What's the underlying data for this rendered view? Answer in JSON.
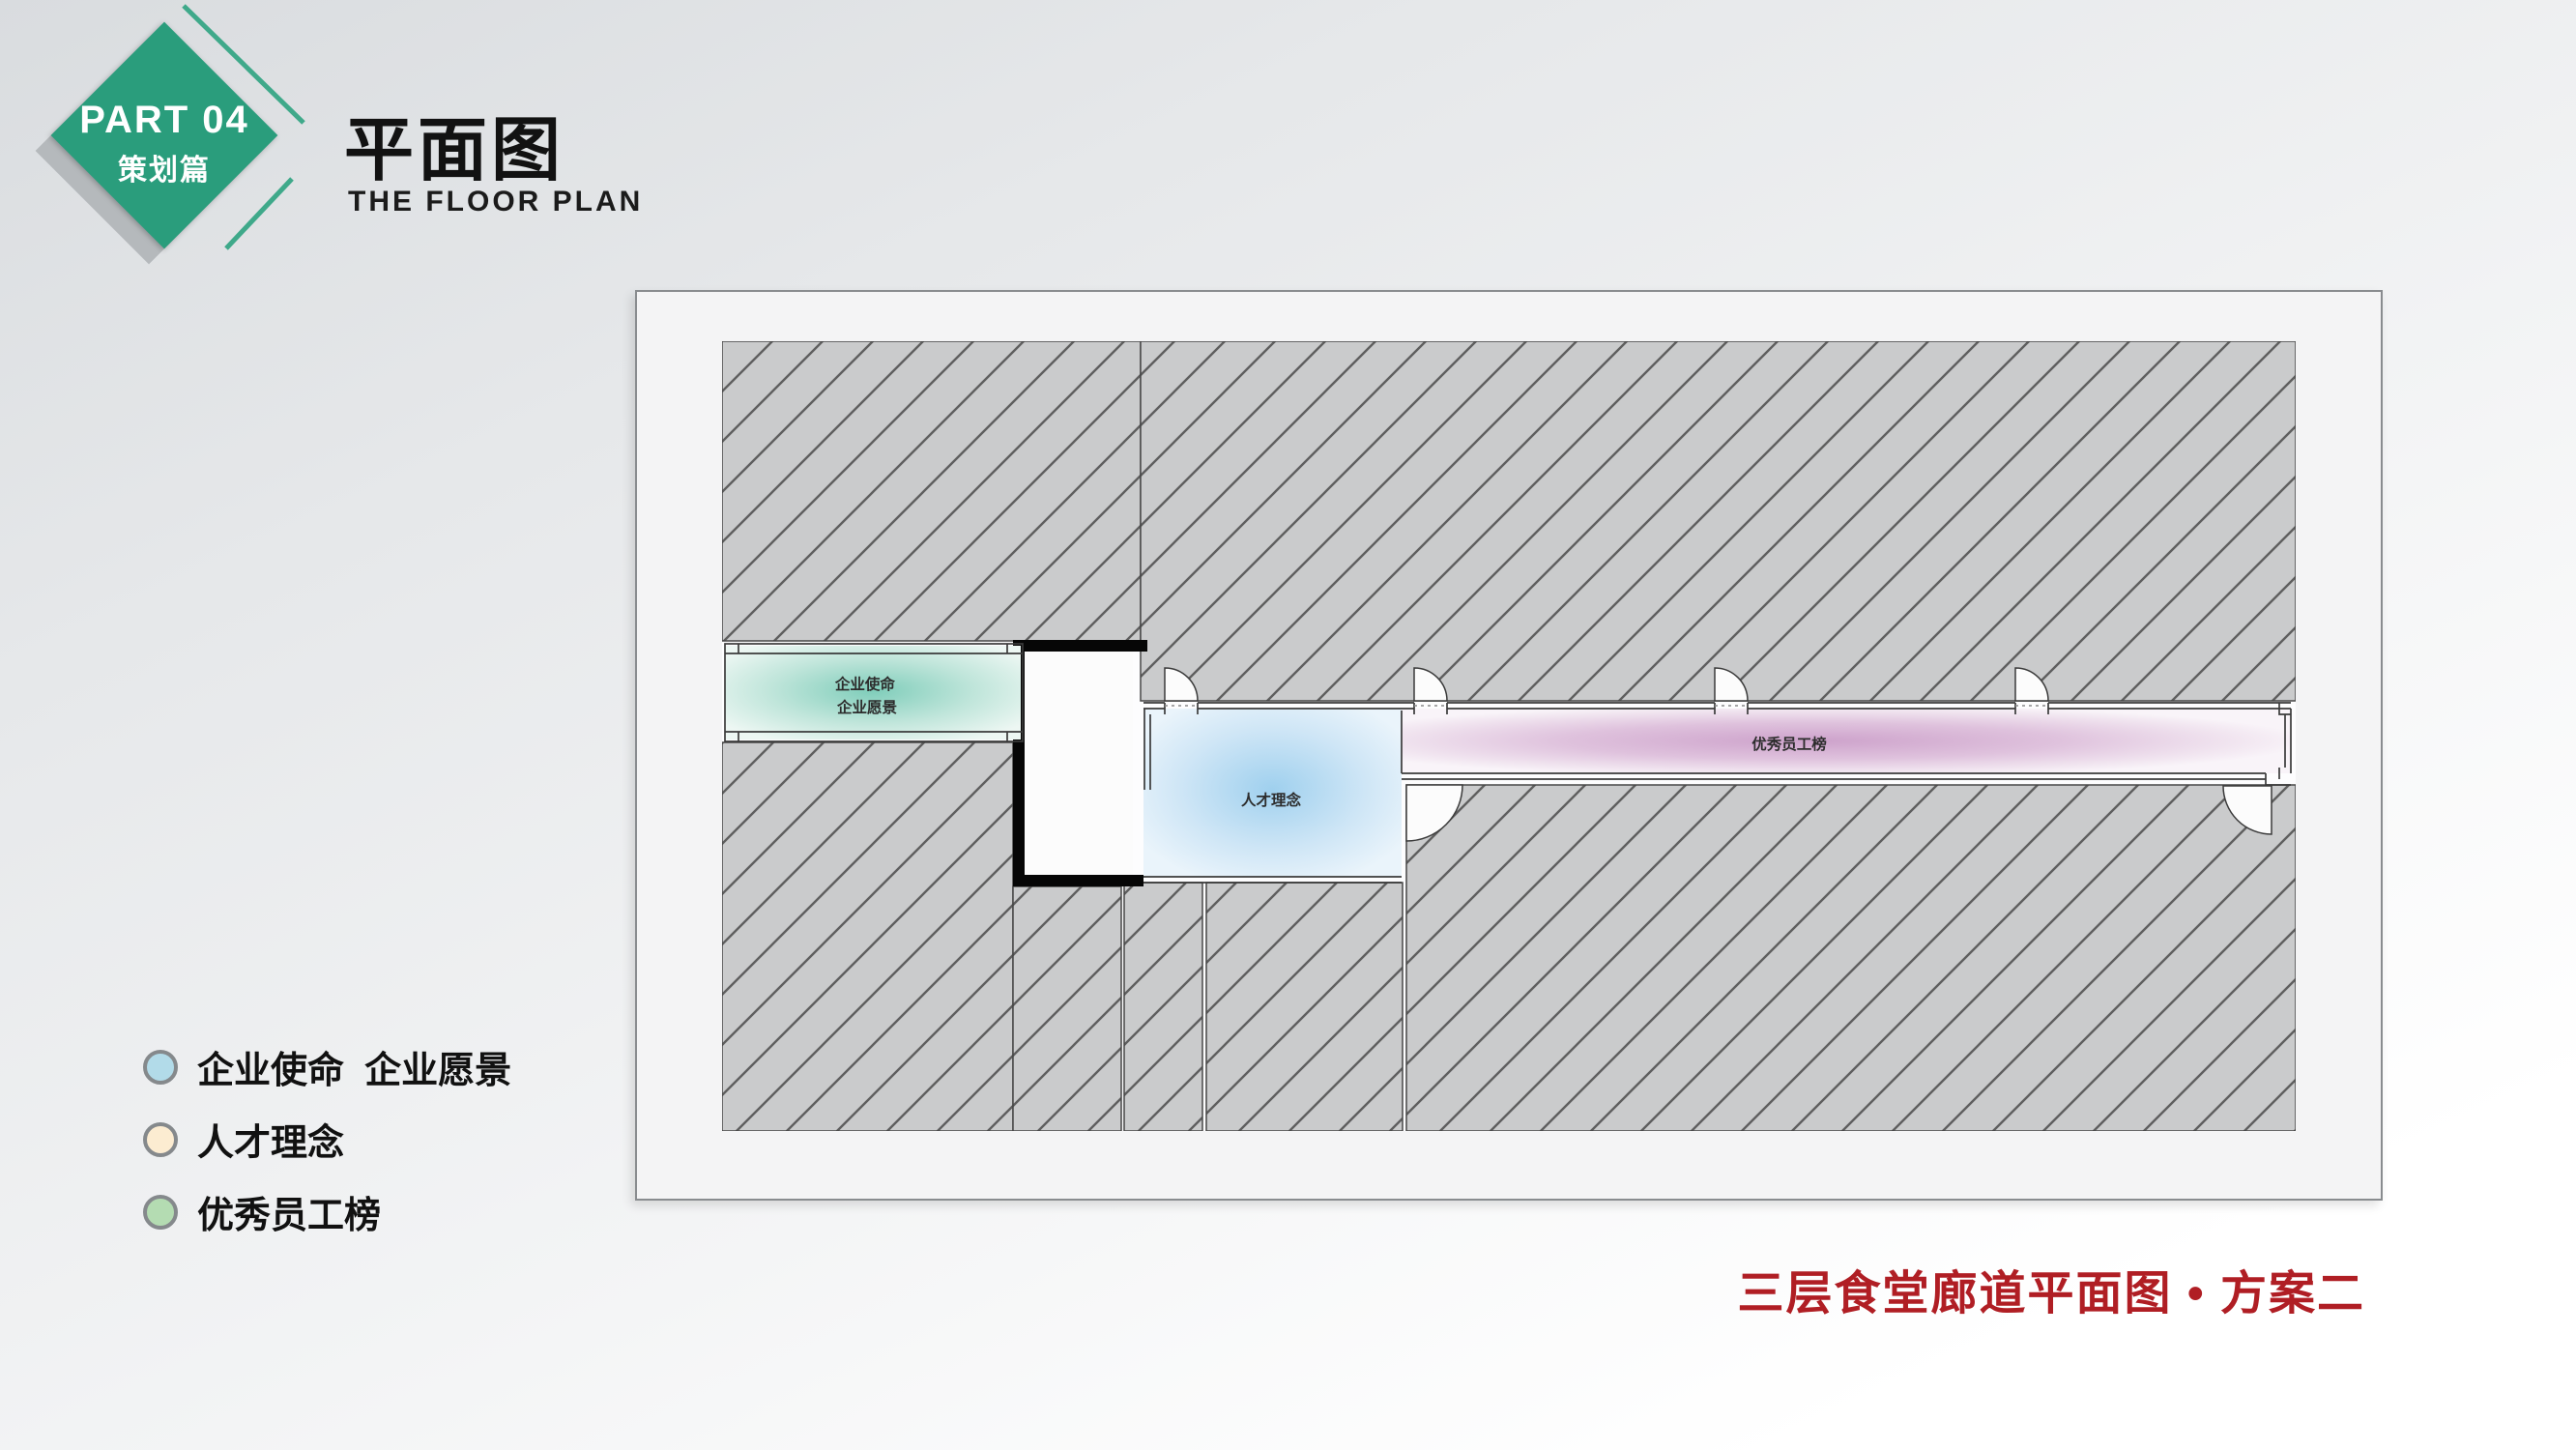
{
  "badge": {
    "part_label": "PART 04",
    "section_label": "策划篇",
    "diamond_color": "#2a9d7c",
    "accent_color": "#3fa98a"
  },
  "header": {
    "title": "平面图",
    "subtitle": "THE FLOOR PLAN"
  },
  "legend": {
    "items": [
      {
        "label": "企业使命  企业愿景",
        "swatch_color": "#b2dbe9"
      },
      {
        "label": "人才理念",
        "swatch_color": "#fcecd1"
      },
      {
        "label": "优秀员工榜",
        "swatch_color": "#b4dcb2"
      }
    ]
  },
  "caption": {
    "text": "三层食堂廊道平面图 • 方案二",
    "color": "#b01e24"
  },
  "floor_plan": {
    "rooms": [
      {
        "name": "mission-vision-room",
        "label_line1": "企业使命",
        "label_line2": "企业愿景",
        "center_color": "#7fcdba",
        "edge_color": "#edf7f3"
      },
      {
        "name": "talent-room",
        "label": "人才理念",
        "center_color": "#9fd0ee",
        "edge_color": "#eaf4fb"
      },
      {
        "name": "staff-board-corridor",
        "label": "优秀员工榜",
        "center_color": "#cda2cb",
        "edge_color": "#f9f4f9"
      }
    ],
    "hatch": {
      "fill": "#cacbcc",
      "line": "#5f5f5f"
    },
    "wall_color": "#3b3b3b"
  }
}
